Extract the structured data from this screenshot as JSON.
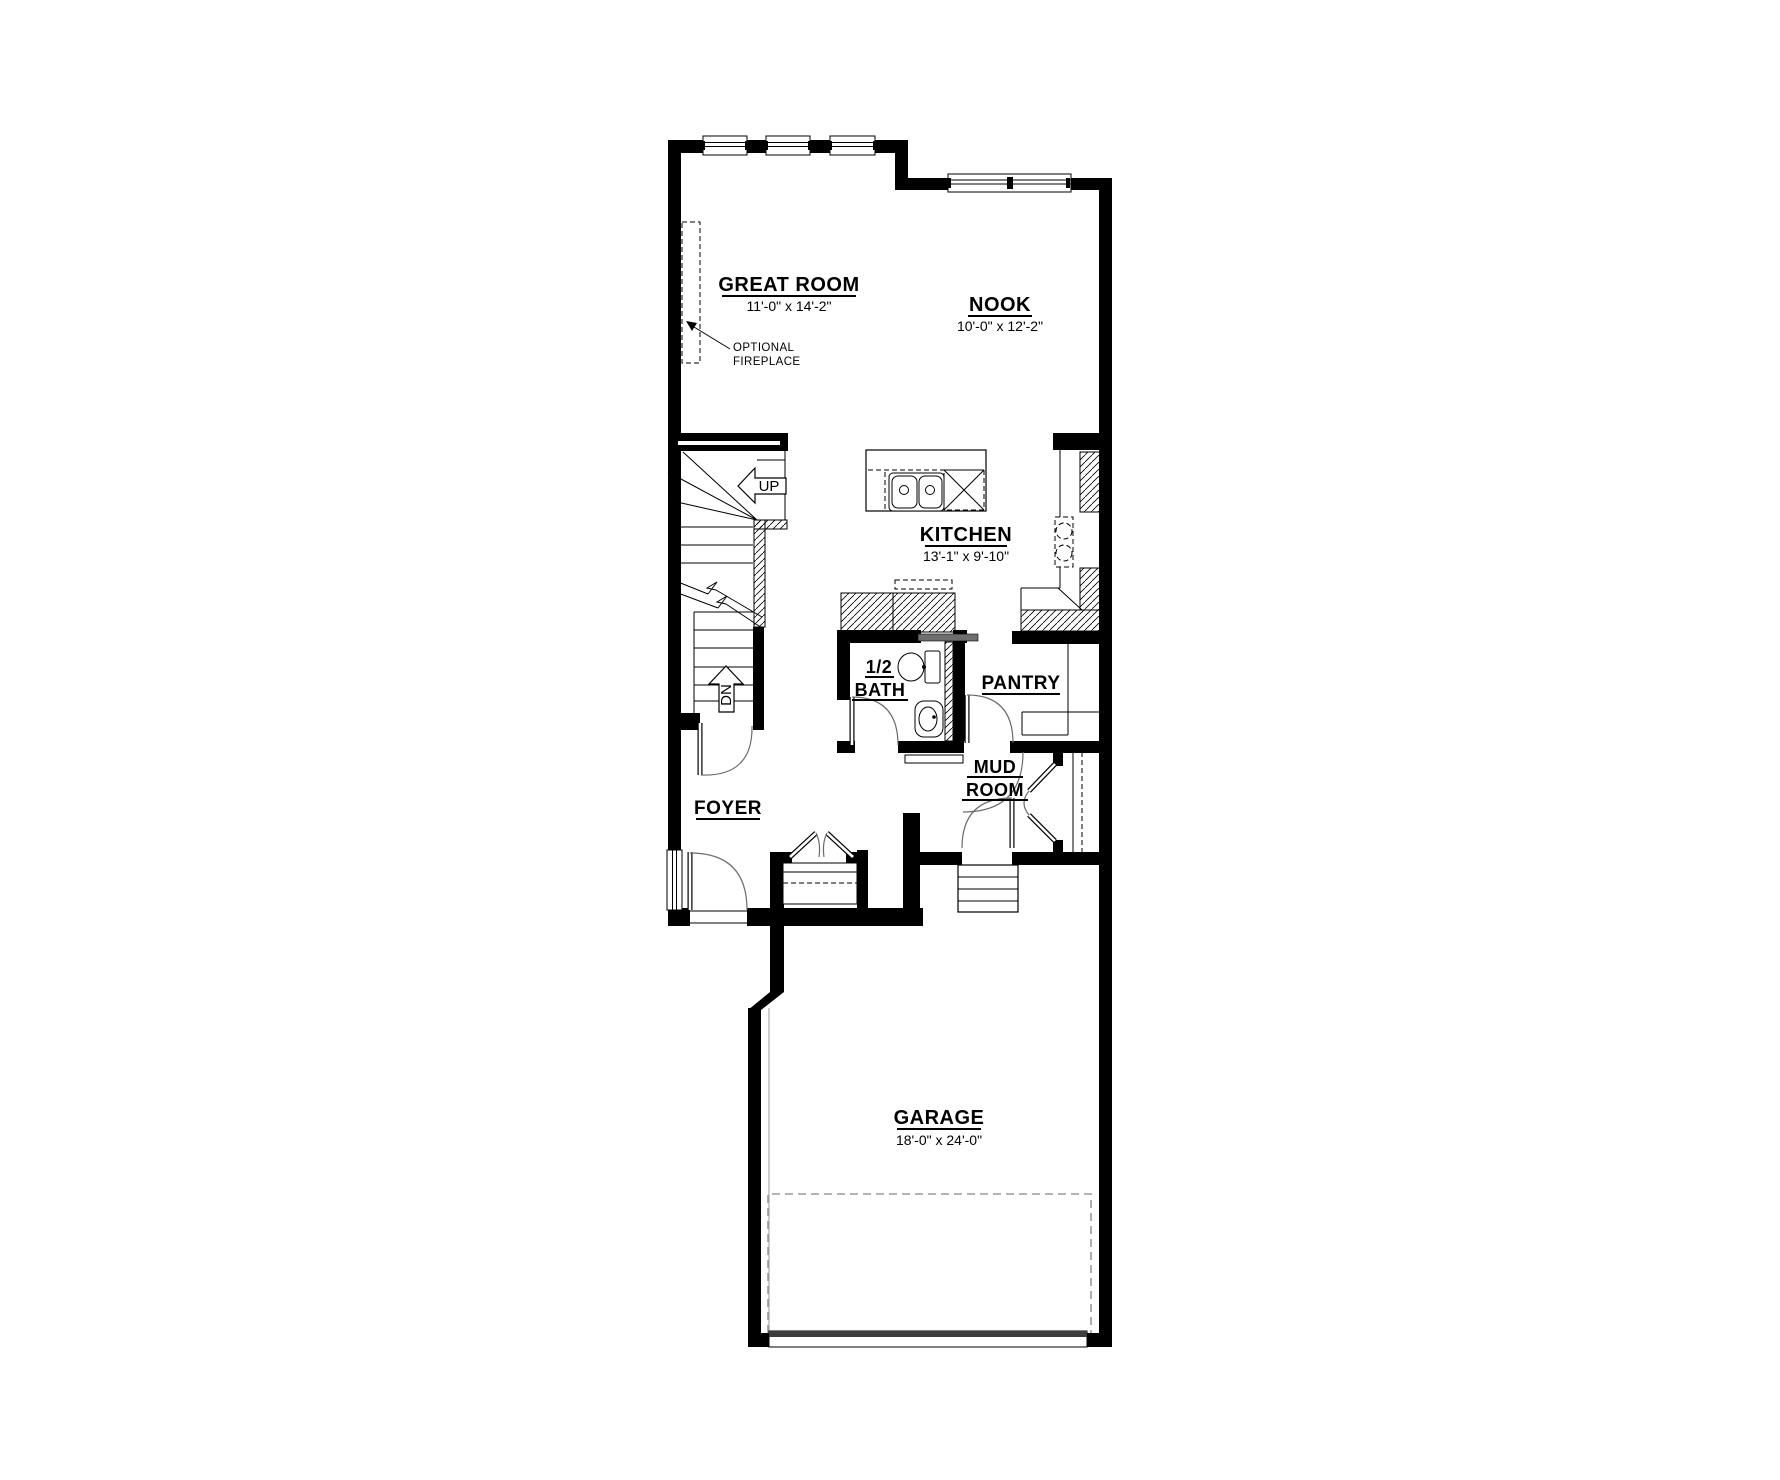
{
  "rooms": {
    "great_room": {
      "label": "GREAT ROOM",
      "dim": "11'-0\" x 14'-2\""
    },
    "nook": {
      "label": "NOOK",
      "dim": "10'-0\" x 12'-2\""
    },
    "kitchen": {
      "label": "KITCHEN",
      "dim": "13'-1\" x 9'-10\""
    },
    "half_bath": {
      "label_top": "1/2",
      "label_bottom": "BATH"
    },
    "pantry": {
      "label": "PANTRY"
    },
    "mud_room": {
      "label_top": "MUD",
      "label_bottom": "ROOM"
    },
    "foyer": {
      "label": "FOYER"
    },
    "garage": {
      "label": "GARAGE",
      "dim": "18'-0\" x 24'-0\""
    }
  },
  "stairs": {
    "up_label": "UP",
    "down_label": "DN"
  },
  "annotations": {
    "fireplace_line1": "OPTIONAL",
    "fireplace_line2": "FIREPLACE"
  },
  "colors": {
    "wall": "#000000",
    "background": "#ffffff",
    "pocket_door_leaf": "#6e6e6e",
    "garage_door_band": "#3d3d3d",
    "garage_apron_dash": "#9a9a9a"
  }
}
